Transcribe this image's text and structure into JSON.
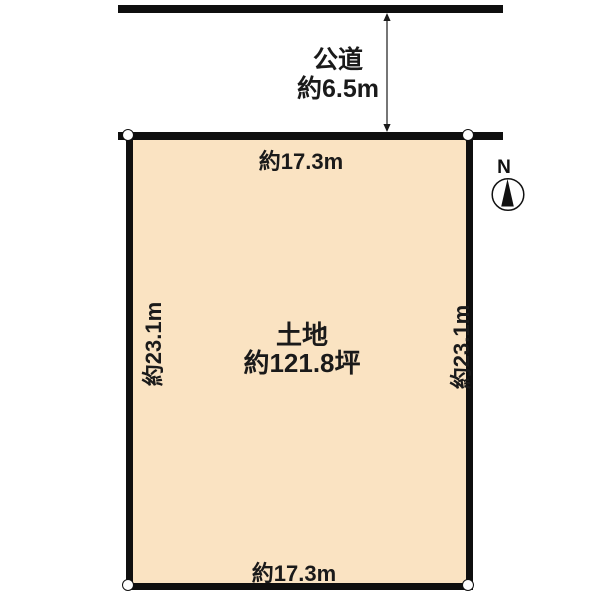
{
  "road": {
    "label": "公道",
    "width_label": "約6.5m"
  },
  "plot": {
    "title": "土地",
    "area_label": "約121.8坪",
    "top_width_label": "約17.3m",
    "bottom_width_label": "約17.3m",
    "left_depth_label": "約23.1m",
    "right_depth_label": "約23.1m"
  },
  "compass": {
    "label": "N"
  },
  "colors": {
    "plot_fill": "#FAE3C2",
    "boundary_line": "#0f0f0f",
    "text": "#1a1a1a"
  }
}
